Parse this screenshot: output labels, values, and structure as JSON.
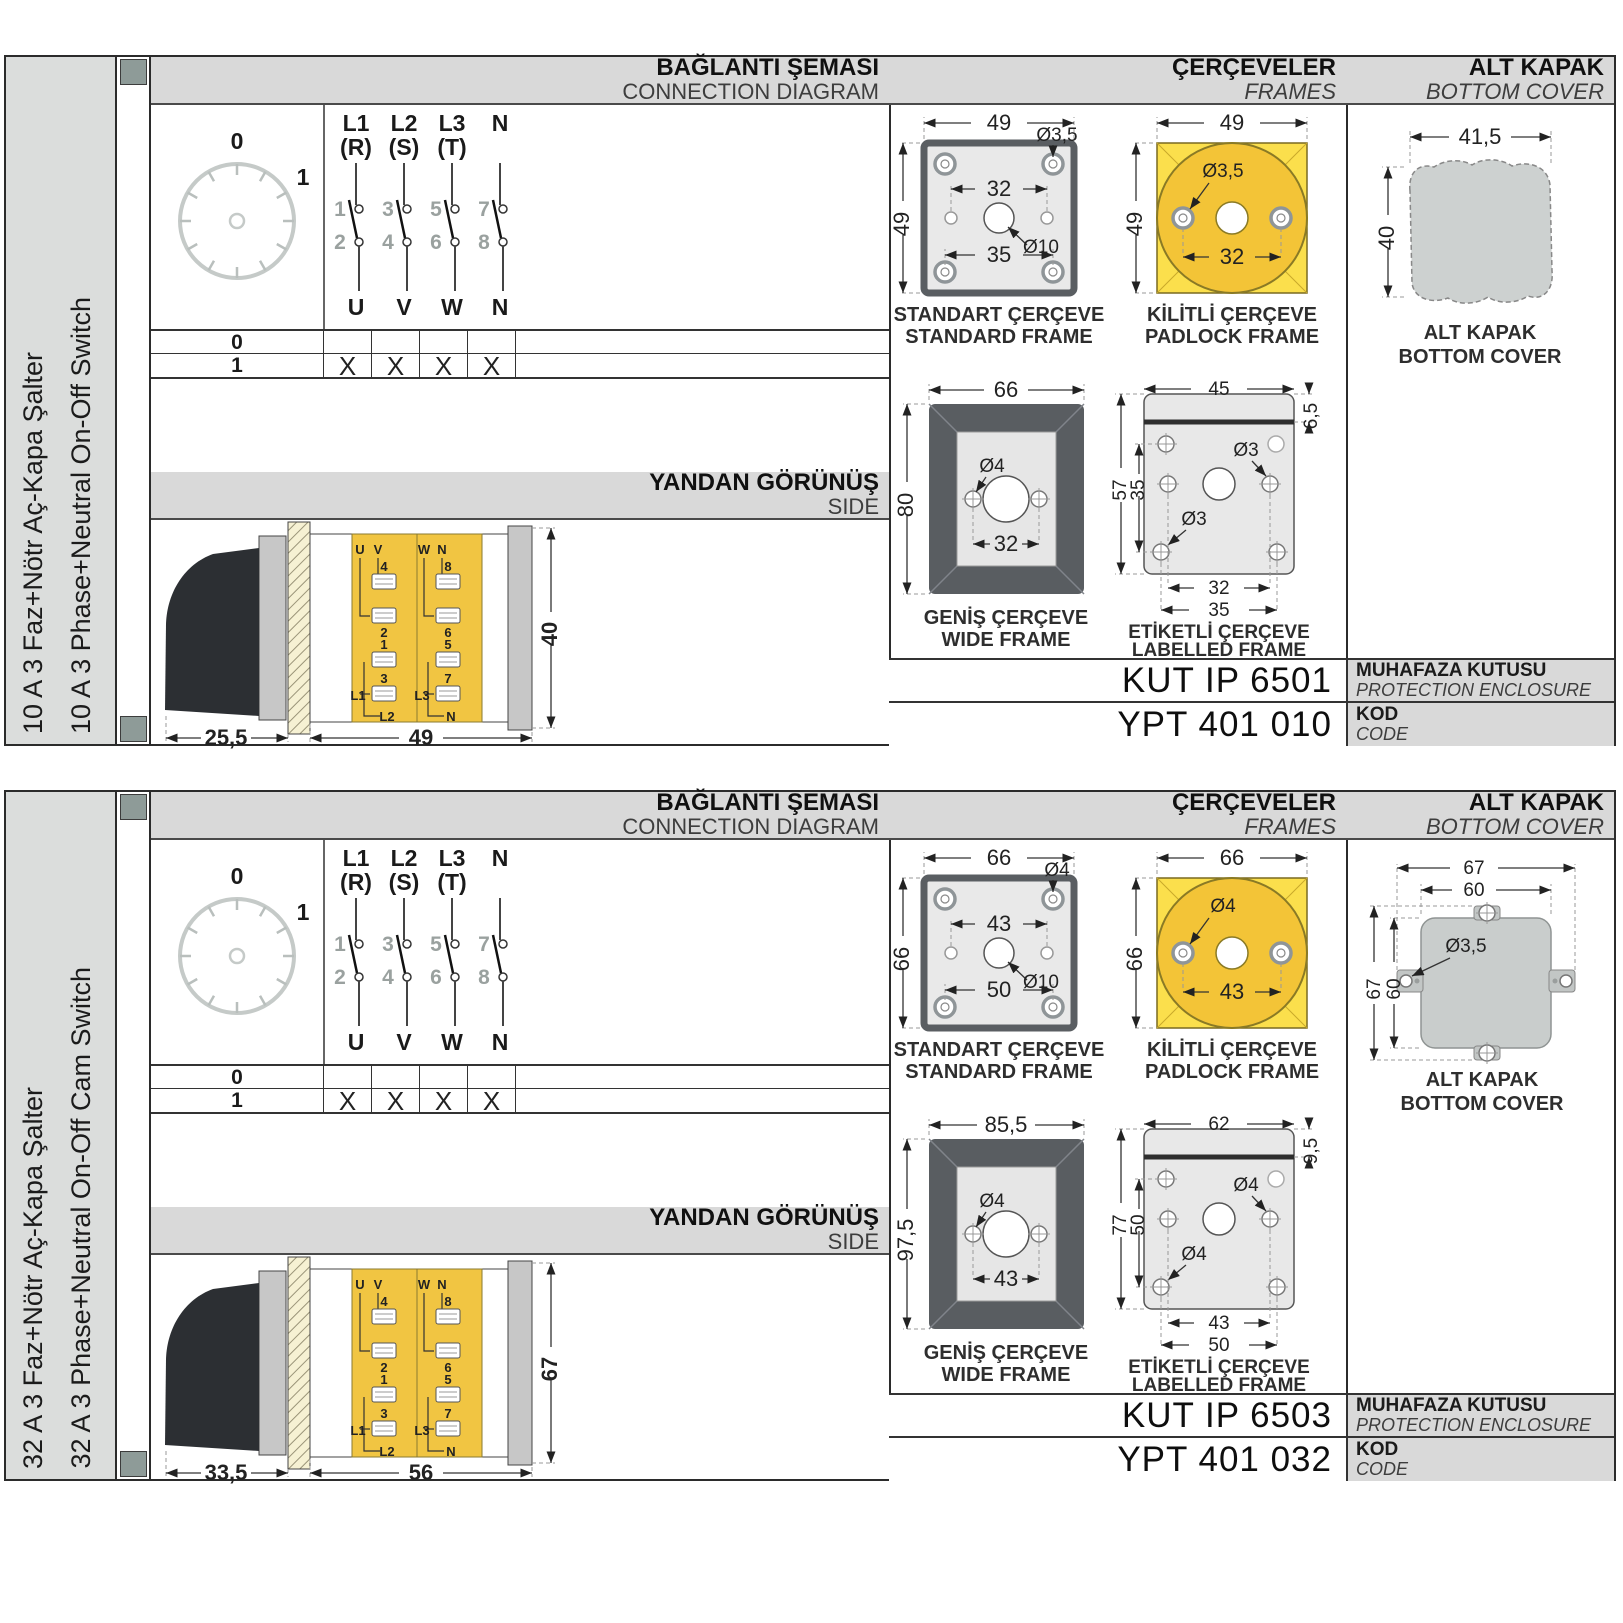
{
  "colors": {
    "body_yellow": "#F1C542",
    "frame_yellow": "#FBDF4C",
    "frame_gold": "#F3C437",
    "header_gray": "#D9D9D9",
    "panel_border": "#2B2B2B",
    "hole_square": "#8E9B98"
  },
  "sections": {
    "connection": {
      "tr": "BAĞLANTI ŞEMASI",
      "en": "CONNECTION DIAGRAM"
    },
    "side": {
      "tr": "YANDAN GÖRÜNÜŞ",
      "en": "SIDE"
    },
    "frames": {
      "tr": "ÇERÇEVELER",
      "en": "FRAMES"
    },
    "cover": {
      "tr": "ALT KAPAK",
      "en": "BOTTOM COVER"
    },
    "enclosure": {
      "tr": "MUHAFAZA KUTUSU",
      "en": "PROTECTION ENCLOSURE"
    },
    "code": {
      "tr": "KOD",
      "en": "CODE"
    },
    "captions": {
      "standard": {
        "tr": "STANDART ÇERÇEVE",
        "en": "STANDARD FRAME"
      },
      "padlock": {
        "tr": "KİLİTLİ ÇERÇEVE",
        "en": "PADLOCK FRAME"
      },
      "wide": {
        "tr": "GENİŞ ÇERÇEVE",
        "en": "WIDE FRAME"
      },
      "labelled": {
        "tr": "ETİKETLİ ÇERÇEVE",
        "en": "LABELLED FRAME"
      },
      "cover": {
        "tr": "ALT KAPAK",
        "en": "BOTTOM COVER"
      }
    },
    "switch": {
      "dial": {
        "p0": "0",
        "p1": "1"
      },
      "cols": [
        {
          "l1": "L1",
          "l2": "(R)",
          "n_top": "1",
          "n_bot": "2",
          "out": "U"
        },
        {
          "l1": "L2",
          "l2": "(S)",
          "n_top": "3",
          "n_bot": "4",
          "out": "V"
        },
        {
          "l1": "L3",
          "l2": "(T)",
          "n_top": "5",
          "n_bot": "6",
          "out": "W"
        },
        {
          "l1": "N",
          "l2": "",
          "n_top": "7",
          "n_bot": "8",
          "out": "N"
        }
      ],
      "rows": [
        {
          "label": "0",
          "m": [
            "",
            "",
            "",
            ""
          ]
        },
        {
          "label": "1",
          "m": [
            "X",
            "X",
            "X",
            "X"
          ]
        }
      ],
      "terms_left": [
        "U",
        "V",
        "4",
        "2",
        "1",
        "3",
        "L1",
        "L2"
      ],
      "terms_right": [
        "W",
        "N",
        "8",
        "6",
        "5",
        "7",
        "L3",
        "N"
      ]
    }
  },
  "panels": [
    {
      "label_tr": "10 A 3 Faz+Nötr Aç-Kapa Şalter",
      "label_en": "10 A 3 Phase+Neutral On-Off Switch",
      "side": {
        "d1": "25,5",
        "d2": "49",
        "d3": "40"
      },
      "standard": {
        "w": "49",
        "h": "49",
        "hole": "Ø3,5",
        "top_span": "32",
        "center": "Ø10",
        "bot_span": "35"
      },
      "padlock": {
        "w": "49",
        "h": "49",
        "hole": "Ø3,5",
        "span": "32"
      },
      "wide": {
        "w": "66",
        "h": "80",
        "hole": "Ø4",
        "span": "32"
      },
      "labelled": {
        "w": "45",
        "band": "6,5",
        "h": "57",
        "inner": "35",
        "hole1": "Ø3",
        "hole2": "Ø3",
        "span1": "32",
        "span2": "35"
      },
      "cover": {
        "w": "41,5",
        "h": "40"
      },
      "codes": {
        "enclosure": "KUT IP 6501",
        "code": "YPT 401 010"
      }
    },
    {
      "label_tr": "32 A 3 Faz+Nötr Aç-Kapa Şalter",
      "label_en": "32 A 3 Phase+Neutral On-Off Cam Switch",
      "side": {
        "d1": "33,5",
        "d2": "56",
        "d3": "67"
      },
      "standard": {
        "w": "66",
        "h": "66",
        "hole": "Ø4",
        "top_span": "43",
        "center": "Ø10",
        "bot_span": "50"
      },
      "padlock": {
        "w": "66",
        "h": "66",
        "hole": "Ø4",
        "span": "43"
      },
      "wide": {
        "w": "85,5",
        "h": "97,5",
        "hole": "Ø4",
        "span": "43"
      },
      "labelled": {
        "w": "62",
        "band": "9,5",
        "h": "77",
        "inner": "50",
        "hole1": "Ø4",
        "hole2": "Ø4",
        "span1": "43",
        "span2": "50"
      },
      "cover": {
        "w1": "67",
        "w2": "60",
        "h1": "67",
        "h2": "60",
        "hole": "Ø3,5"
      },
      "codes": {
        "enclosure": "KUT IP 6503",
        "code": "YPT 401 032"
      }
    }
  ]
}
